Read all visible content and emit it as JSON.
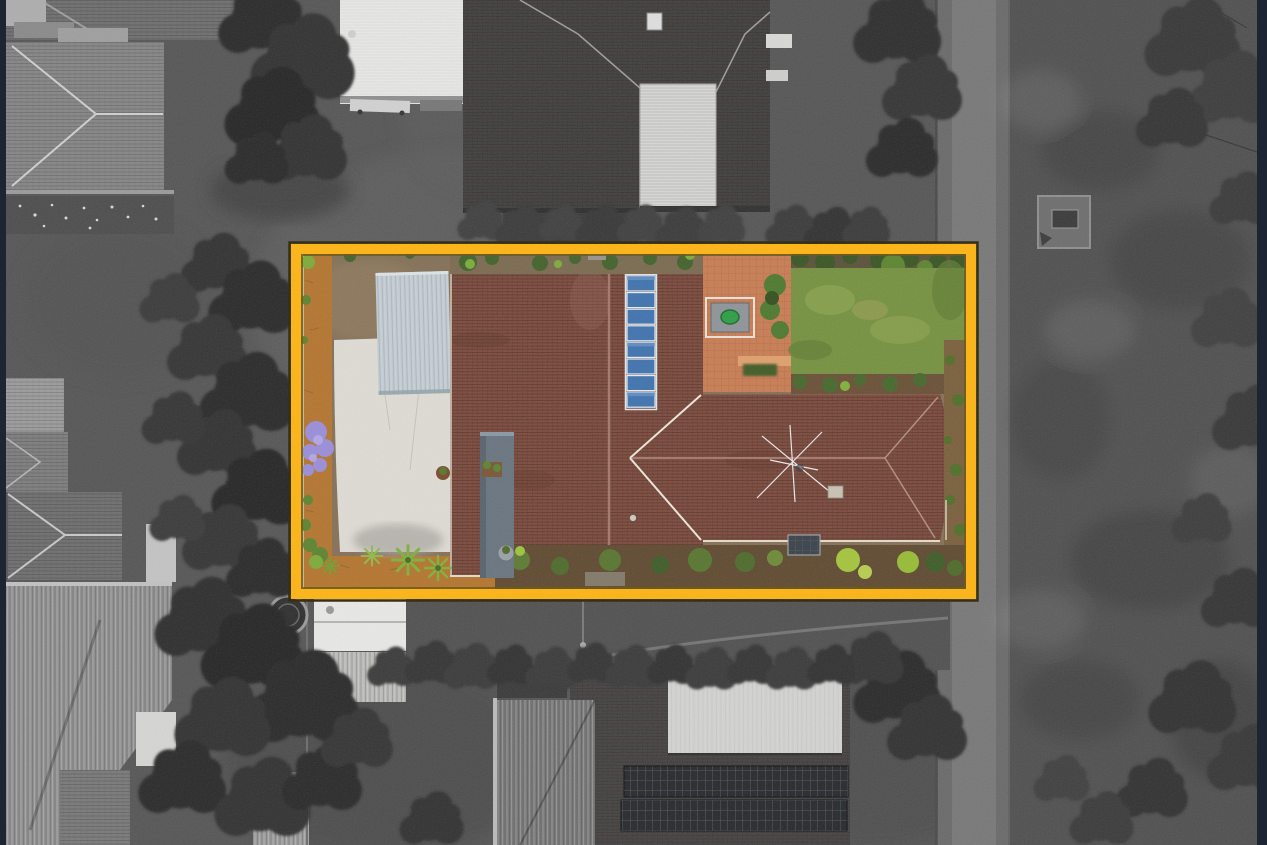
{
  "image": {
    "kind": "aerial-drone-photograph",
    "view": "top-down (nadir) of suburban residential block",
    "treatment": "subject lot shown in full colour inside an amber boundary box; surrounding neighbourhood desaturated to greyscale",
    "text_content": "none - photograph contains no visible text"
  },
  "highlight_box": {
    "left": 291,
    "top": 244,
    "width": 686,
    "height": 356,
    "border_px": 10
  },
  "palette": {
    "frame_bar": "#1c2531",
    "highlight_amber": "#ffb412",
    "highlight_edge_outer": "#2e2708",
    "highlight_edge_inner": "#6a5512",
    "roof_tile_brown": "#7b4b3e",
    "roof_ridge_light": "#a3796a",
    "solar_panel_blue": "#3f73ae",
    "carport_roof": "#c2ccd2",
    "concrete_driveway": "#dedcd4",
    "dirt_orange": "#b3752f",
    "dirt_tan": "#857057",
    "lawn_green": "#75913f",
    "hedge_green": "#42622a",
    "bright_shrub_green": "#7cab3a",
    "courtyard_paving": "#c87d53",
    "jacaranda_purple": "#9a8ed9",
    "spa_cover_green": "#2e9e45",
    "tank_bluegray": "#68747f",
    "grey_ground": "#565656",
    "grey_roof_dark": "#3f3f3f",
    "grey_field": "#505050",
    "grey_path": "#787878",
    "grey_building_white": "#e9e9e7"
  },
  "scene": {
    "highlighted_property": {
      "position": "centre of frame inside amber boundary box",
      "solar_panel_count": 8,
      "features": [
        {
          "name": "main-house-tiled-roof",
          "desc": "brown terracotta tile gable roof running top to bottom"
        },
        {
          "name": "rear-wing-hip-roof",
          "desc": "brown tile hip-roof wing extending right, with TV antenna"
        },
        {
          "name": "solar-panel-array",
          "desc": "single column of 8 blue solar panels on east roof plane"
        },
        {
          "name": "carport-metal-roof",
          "desc": "pale grey corrugated carport left of house"
        },
        {
          "name": "concrete-driveway",
          "desc": "large light concrete pad on left of lot"
        },
        {
          "name": "orange-gravel-edging",
          "desc": "orange dirt/gravel strip along left and bottom boundary"
        },
        {
          "name": "jacaranda-tree",
          "desc": "purple flowering tree on left boundary"
        },
        {
          "name": "paved-courtyard",
          "desc": "terracotta paved courtyard behind house"
        },
        {
          "name": "spa-pergola",
          "desc": "grey pergola with green covered spa in courtyard"
        },
        {
          "name": "back-lawn",
          "desc": "green lawn in top right of lot"
        },
        {
          "name": "garden-beds",
          "desc": "shrub, palm and mulch beds along bottom and right boundaries"
        }
      ]
    },
    "surroundings": [
      {
        "name": "neighbour-house-top-left",
        "desc": "grey hip-roof house"
      },
      {
        "name": "white-shed-top",
        "desc": "white flat-roof shed with trailer below"
      },
      {
        "name": "neighbour-house-top-centre",
        "desc": "large dark-tile house with white ribbed carport roof and skylight"
      },
      {
        "name": "neighbour-house-bottom",
        "desc": "dark-tile house with light metal roof section and two rows of grey solar panels"
      },
      {
        "name": "neighbour-houses-left",
        "desc": "row of grey-roofed houses along left edge"
      },
      {
        "name": "round-pool",
        "desc": "small round dark pool left of box bottom corner"
      },
      {
        "name": "laneway-right",
        "desc": "light vertical laneway/footpath on right side"
      },
      {
        "name": "paddock-right",
        "desc": "large mottled grey field along right edge"
      },
      {
        "name": "dense-trees",
        "desc": "dark tree and hedge clusters between properties"
      }
    ]
  }
}
